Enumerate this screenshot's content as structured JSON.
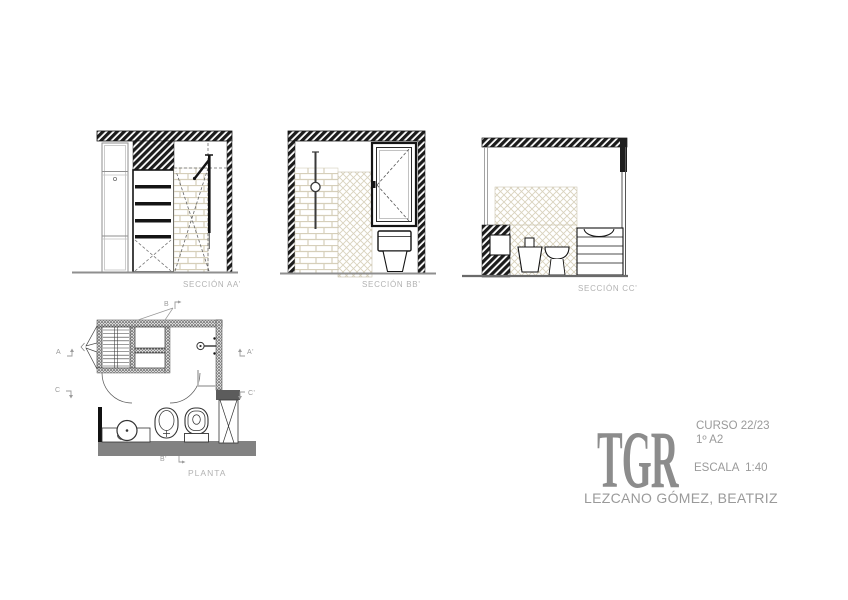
{
  "drawings": {
    "section_aa": {
      "label": "SECCIÓN AA'"
    },
    "section_bb": {
      "label": "SECCIÓN BB'"
    },
    "section_cc": {
      "label": "SECCIÓN CC'"
    },
    "plan": {
      "label": "PLANTA",
      "cut_markers": {
        "a": "A",
        "a_prime": "A'",
        "b": "B",
        "b_prime": "B'",
        "c": "C",
        "c_prime": "C'"
      }
    }
  },
  "title_block": {
    "logo": "TGR",
    "course": "CURSO 22/23",
    "group": "1º A2",
    "scale": "ESCALA  1:40",
    "author": "LEZCANO GÓMEZ, BEATRIZ"
  },
  "colors": {
    "ink": "#1a1a1a",
    "tile_joint": "#d6cfba",
    "label_gray": "#b2b2b2",
    "annotation_gray": "#9b9b9b",
    "logo_gray": "#8c8c8c",
    "title_gray": "#9a9a9a",
    "poche_gray": "#828282"
  }
}
